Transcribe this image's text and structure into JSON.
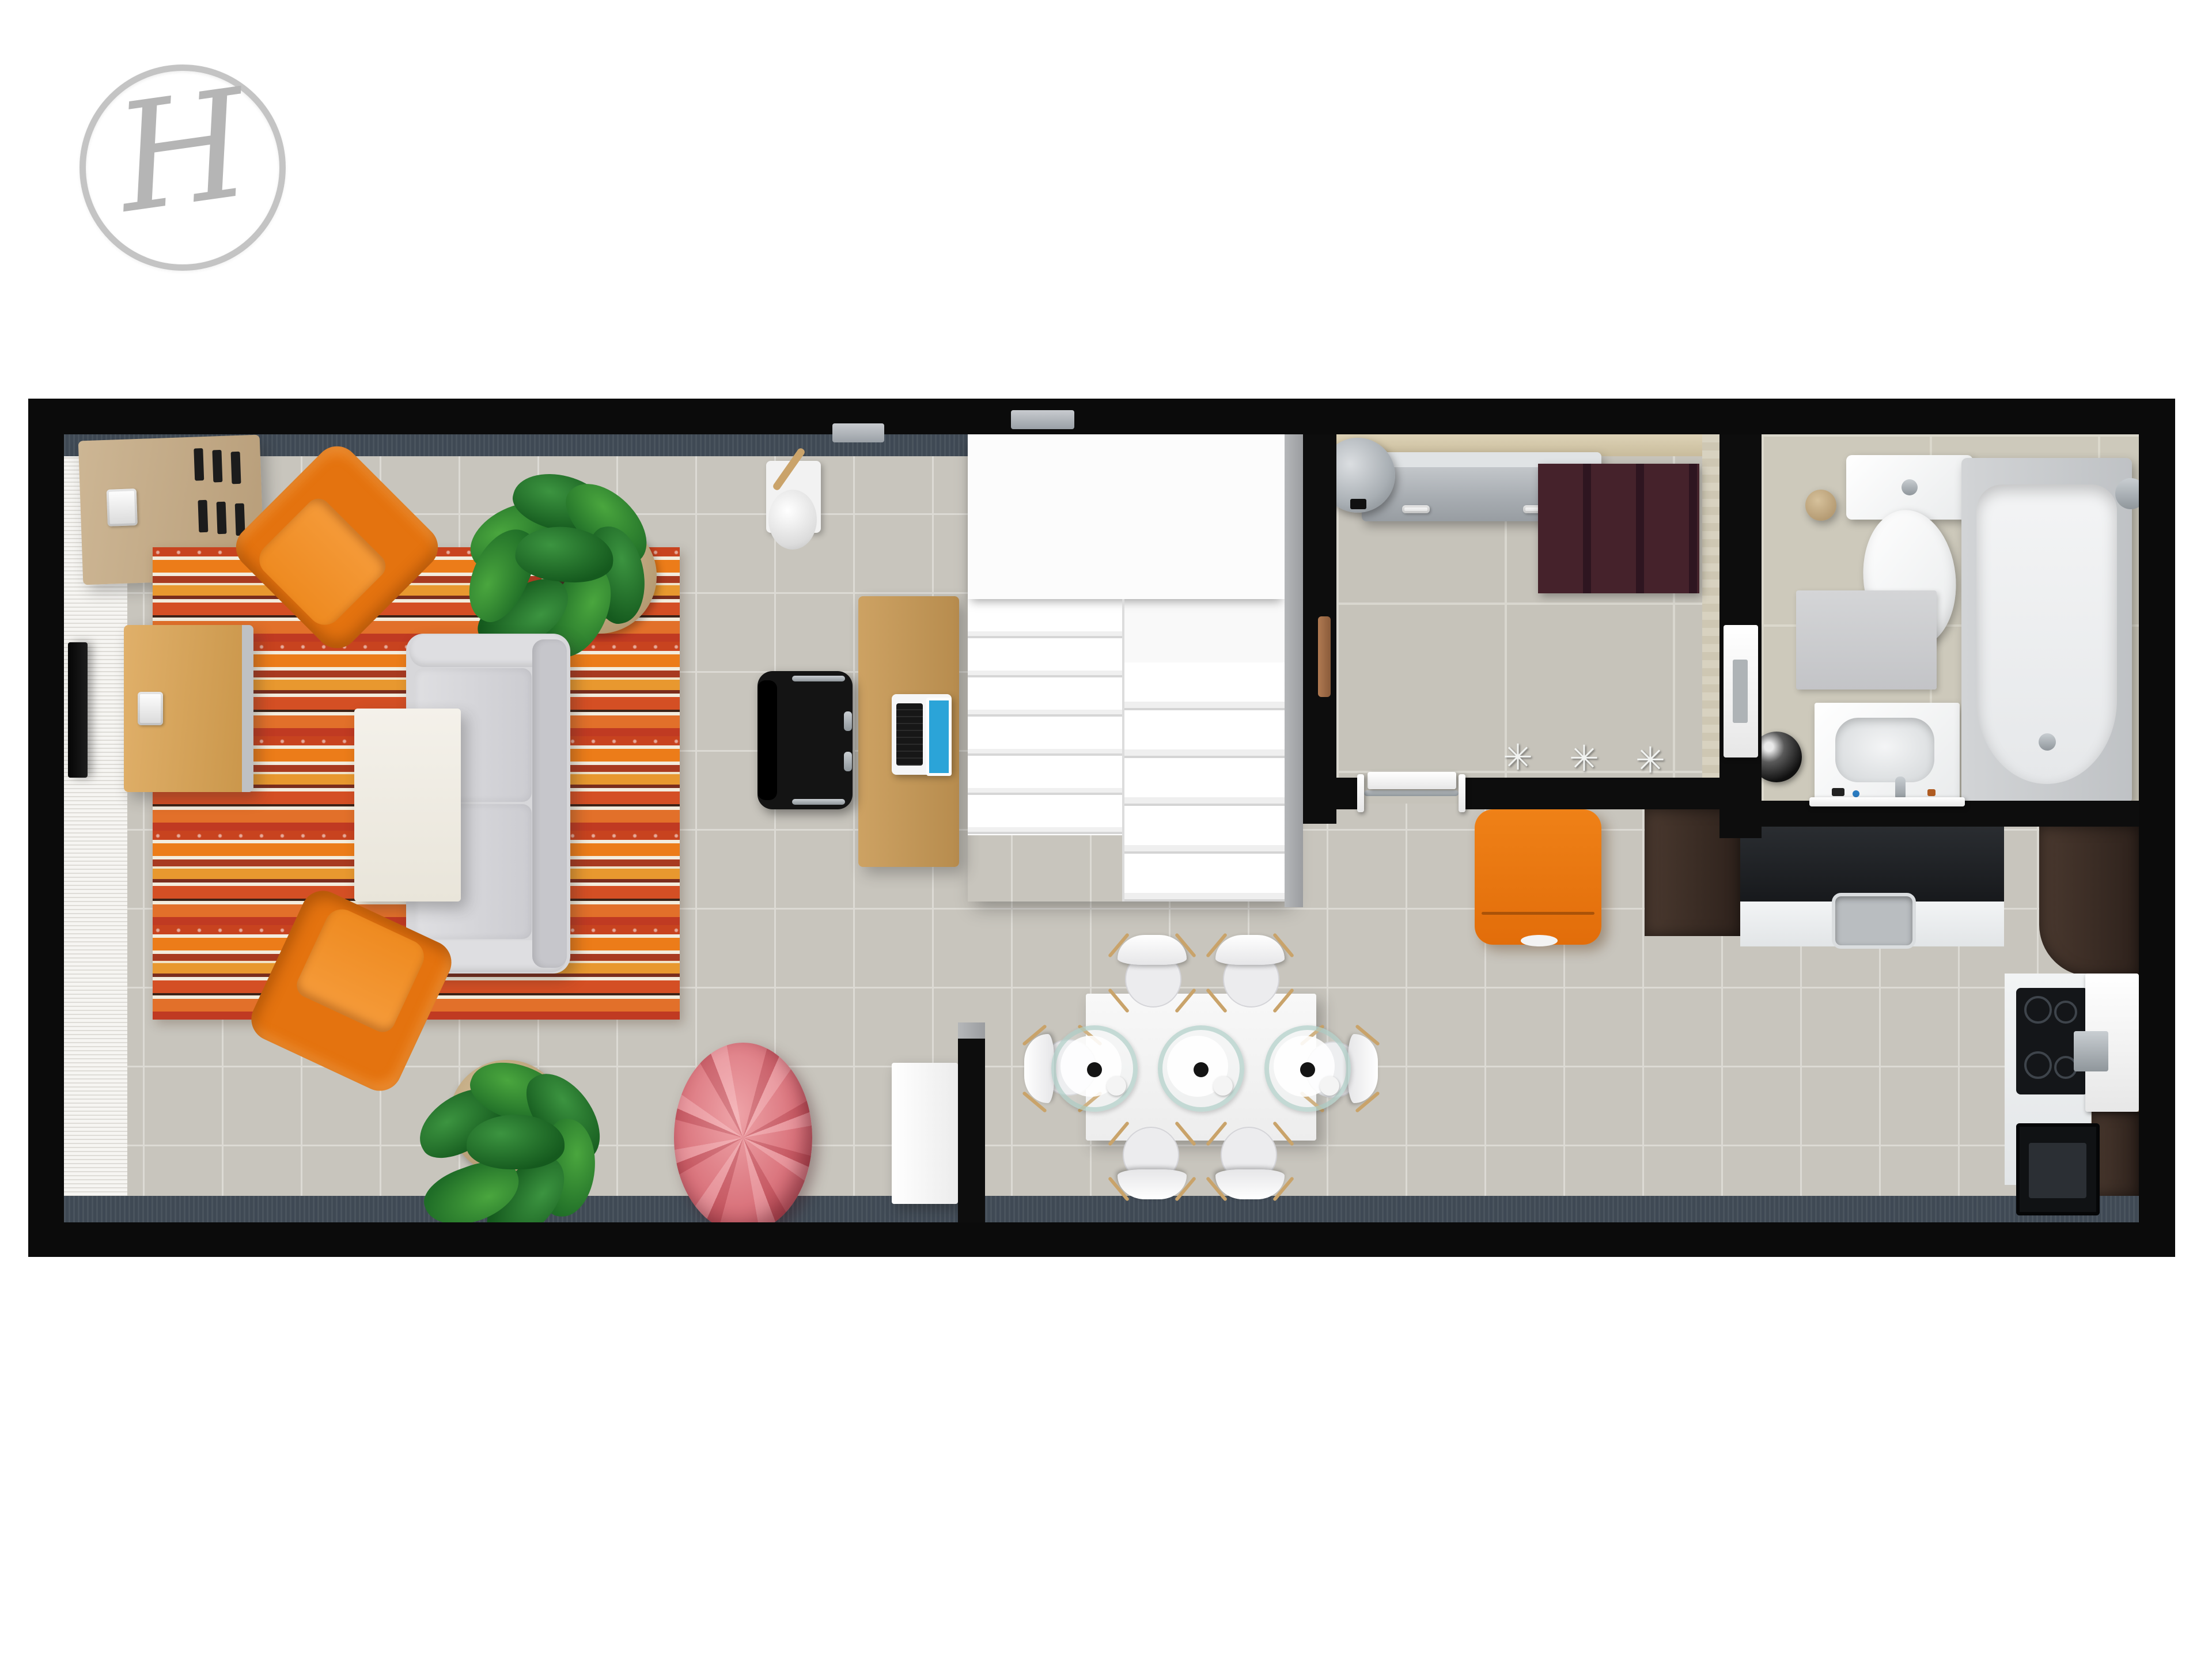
{
  "logo": {
    "monogram": "H",
    "ring_color": "#c4c4c4",
    "letter_color": "#b5b5b5"
  },
  "glyphs": {
    "floor_hook": "✳"
  },
  "palette": {
    "page_background": "#ffffff",
    "wall": "#0b0b0b",
    "floor_tile": "#c8c5bd",
    "grout": "#dcdad4",
    "window_band": "#3f4954",
    "wallpaper": "#f6f5f2",
    "accent_orange": "#e4730f",
    "rug_red": "#c8431f",
    "rug_cream": "#f3ecdd",
    "pouf_pink": "#d9757d",
    "sofa_grey": "#d7d7da",
    "wood_light": "#cda263",
    "wood_dark": "#3a2d25",
    "stair_white": "#fcfcfc",
    "plant_green": "#2e7d32",
    "laptop_screen_blue": "#2ba4d8",
    "utility_rug_maroon": "#45222b"
  },
  "floorplan": {
    "rooms": [
      {
        "id": "living-room",
        "label": "Living room",
        "furniture": [
          "wall-tv",
          "tv-bench",
          "sideboard",
          "striped-rug",
          "sofa",
          "coffee-table",
          "orange-armchair-top",
          "orange-armchair-bottom",
          "potted-plant-top",
          "potted-plant-bottom",
          "pink-pouf",
          "wall-lamp",
          "wooden-desk",
          "office-chair",
          "laptop",
          "staircase"
        ]
      },
      {
        "id": "dining-area",
        "label": "Dining area",
        "furniture": [
          "dining-table",
          "dining-chair-x6",
          "glass-place-setting-x3",
          "white-cabinet",
          "partition-wall"
        ]
      },
      {
        "id": "utility-room",
        "label": "Utility room",
        "furniture": [
          "water-heater",
          "radiator-cabinet",
          "maroon-rug",
          "floor-hook-x3",
          "sliding-door"
        ]
      },
      {
        "id": "bathroom",
        "label": "Bathroom",
        "furniture": [
          "toilet",
          "toilet-roll-holder",
          "bath-mat",
          "washbasin-vanity",
          "waste-bin",
          "bathtub",
          "bathroom-door"
        ]
      },
      {
        "id": "kitchen",
        "label": "Kitchen",
        "furniture": [
          "orange-lounge-chair",
          "wenge-cabinet-left",
          "black-countertop",
          "kitchen-sink",
          "wenge-cabinet-corner",
          "induction-hob",
          "extractor-unit",
          "oven"
        ]
      }
    ]
  }
}
